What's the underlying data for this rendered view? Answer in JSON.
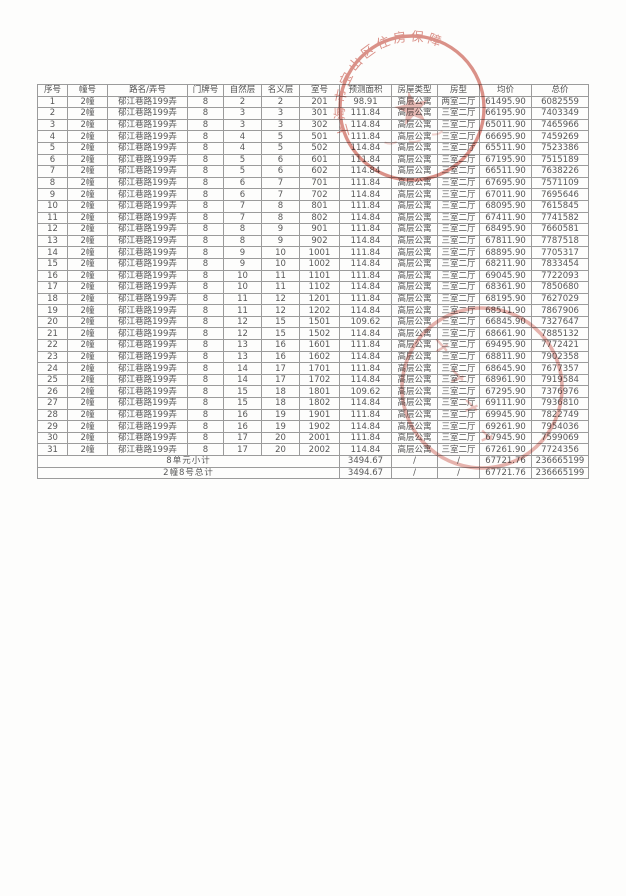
{
  "table": {
    "columns": [
      "序号",
      "幢号",
      "路名/弄号",
      "门牌号",
      "自然层",
      "名义层",
      "室号",
      "预测面积",
      "房屋类型",
      "房型",
      "均价",
      "总价"
    ],
    "rows": [
      [
        "1",
        "2幢",
        "郁江巷路199弄",
        "8",
        "2",
        "2",
        "201",
        "98.91",
        "高层公寓",
        "两室二厅",
        "61495.90",
        "6082559"
      ],
      [
        "2",
        "2幢",
        "郁江巷路199弄",
        "8",
        "3",
        "3",
        "301",
        "111.84",
        "高层公寓",
        "三室二厅",
        "66195.90",
        "7403349"
      ],
      [
        "3",
        "2幢",
        "郁江巷路199弄",
        "8",
        "3",
        "3",
        "302",
        "114.84",
        "高层公寓",
        "三室二厅",
        "65011.90",
        "7465966"
      ],
      [
        "4",
        "2幢",
        "郁江巷路199弄",
        "8",
        "4",
        "5",
        "501",
        "111.84",
        "高层公寓",
        "三室二厅",
        "66695.90",
        "7459269"
      ],
      [
        "5",
        "2幢",
        "郁江巷路199弄",
        "8",
        "4",
        "5",
        "502",
        "114.84",
        "高层公寓",
        "三室二厅",
        "65511.90",
        "7523386"
      ],
      [
        "6",
        "2幢",
        "郁江巷路199弄",
        "8",
        "5",
        "6",
        "601",
        "111.84",
        "高层公寓",
        "三室二厅",
        "67195.90",
        "7515189"
      ],
      [
        "7",
        "2幢",
        "郁江巷路199弄",
        "8",
        "5",
        "6",
        "602",
        "114.84",
        "高层公寓",
        "三室二厅",
        "66511.90",
        "7638226"
      ],
      [
        "8",
        "2幢",
        "郁江巷路199弄",
        "8",
        "6",
        "7",
        "701",
        "111.84",
        "高层公寓",
        "三室二厅",
        "67695.90",
        "7571109"
      ],
      [
        "9",
        "2幢",
        "郁江巷路199弄",
        "8",
        "6",
        "7",
        "702",
        "114.84",
        "高层公寓",
        "三室二厅",
        "67011.90",
        "7695646"
      ],
      [
        "10",
        "2幢",
        "郁江巷路199弄",
        "8",
        "7",
        "8",
        "801",
        "111.84",
        "高层公寓",
        "三室二厅",
        "68095.90",
        "7615845"
      ],
      [
        "11",
        "2幢",
        "郁江巷路199弄",
        "8",
        "7",
        "8",
        "802",
        "114.84",
        "高层公寓",
        "三室二厅",
        "67411.90",
        "7741582"
      ],
      [
        "12",
        "2幢",
        "郁江巷路199弄",
        "8",
        "8",
        "9",
        "901",
        "111.84",
        "高层公寓",
        "三室二厅",
        "68495.90",
        "7660581"
      ],
      [
        "13",
        "2幢",
        "郁江巷路199弄",
        "8",
        "8",
        "9",
        "902",
        "114.84",
        "高层公寓",
        "三室二厅",
        "67811.90",
        "7787518"
      ],
      [
        "14",
        "2幢",
        "郁江巷路199弄",
        "8",
        "9",
        "10",
        "1001",
        "111.84",
        "高层公寓",
        "三室二厅",
        "68895.90",
        "7705317"
      ],
      [
        "15",
        "2幢",
        "郁江巷路199弄",
        "8",
        "9",
        "10",
        "1002",
        "114.84",
        "高层公寓",
        "三室二厅",
        "68211.90",
        "7833454"
      ],
      [
        "16",
        "2幢",
        "郁江巷路199弄",
        "8",
        "10",
        "11",
        "1101",
        "111.84",
        "高层公寓",
        "三室二厅",
        "69045.90",
        "7722093"
      ],
      [
        "17",
        "2幢",
        "郁江巷路199弄",
        "8",
        "10",
        "11",
        "1102",
        "114.84",
        "高层公寓",
        "三室二厅",
        "68361.90",
        "7850680"
      ],
      [
        "18",
        "2幢",
        "郁江巷路199弄",
        "8",
        "11",
        "12",
        "1201",
        "111.84",
        "高层公寓",
        "三室二厅",
        "68195.90",
        "7627029"
      ],
      [
        "19",
        "2幢",
        "郁江巷路199弄",
        "8",
        "11",
        "12",
        "1202",
        "114.84",
        "高层公寓",
        "三室二厅",
        "68511.90",
        "7867906"
      ],
      [
        "20",
        "2幢",
        "郁江巷路199弄",
        "8",
        "12",
        "15",
        "1501",
        "109.62",
        "高层公寓",
        "三室二厅",
        "66845.90",
        "7327647"
      ],
      [
        "21",
        "2幢",
        "郁江巷路199弄",
        "8",
        "12",
        "15",
        "1502",
        "114.84",
        "高层公寓",
        "三室二厅",
        "68661.90",
        "7885132"
      ],
      [
        "22",
        "2幢",
        "郁江巷路199弄",
        "8",
        "13",
        "16",
        "1601",
        "111.84",
        "高层公寓",
        "三室二厅",
        "69495.90",
        "7772421"
      ],
      [
        "23",
        "2幢",
        "郁江巷路199弄",
        "8",
        "13",
        "16",
        "1602",
        "114.84",
        "高层公寓",
        "三室二厅",
        "68811.90",
        "7902358"
      ],
      [
        "24",
        "2幢",
        "郁江巷路199弄",
        "8",
        "14",
        "17",
        "1701",
        "111.84",
        "高层公寓",
        "三室二厅",
        "68645.90",
        "7677357"
      ],
      [
        "25",
        "2幢",
        "郁江巷路199弄",
        "8",
        "14",
        "17",
        "1702",
        "114.84",
        "高层公寓",
        "三室二厅",
        "68961.90",
        "7919584"
      ],
      [
        "26",
        "2幢",
        "郁江巷路199弄",
        "8",
        "15",
        "18",
        "1801",
        "109.62",
        "高层公寓",
        "三室二厅",
        "67295.90",
        "7376976"
      ],
      [
        "27",
        "2幢",
        "郁江巷路199弄",
        "8",
        "15",
        "18",
        "1802",
        "114.84",
        "高层公寓",
        "三室二厅",
        "69111.90",
        "7936810"
      ],
      [
        "28",
        "2幢",
        "郁江巷路199弄",
        "8",
        "16",
        "19",
        "1901",
        "111.84",
        "高层公寓",
        "三室二厅",
        "69945.90",
        "7822749"
      ],
      [
        "29",
        "2幢",
        "郁江巷路199弄",
        "8",
        "16",
        "19",
        "1902",
        "114.84",
        "高层公寓",
        "三室二厅",
        "69261.90",
        "7954036"
      ],
      [
        "30",
        "2幢",
        "郁江巷路199弄",
        "8",
        "17",
        "20",
        "2001",
        "111.84",
        "高层公寓",
        "三室二厅",
        "67945.90",
        "7599069"
      ],
      [
        "31",
        "2幢",
        "郁江巷路199弄",
        "8",
        "17",
        "20",
        "2002",
        "114.84",
        "高层公寓",
        "三室二厅",
        "67261.90",
        "7724356"
      ]
    ],
    "summary_rows": [
      [
        "8单元小计",
        "3494.67",
        "/",
        "/",
        "67721.76",
        "236665199"
      ],
      [
        "2幢8号总计",
        "3494.67",
        "/",
        "/",
        "67721.76",
        "236665199"
      ]
    ]
  },
  "stamps": {
    "top": {
      "arc_text": "上海市宝山区住房保障",
      "color": "#c0392b"
    },
    "bottom": {
      "color": "#c0392b"
    }
  }
}
